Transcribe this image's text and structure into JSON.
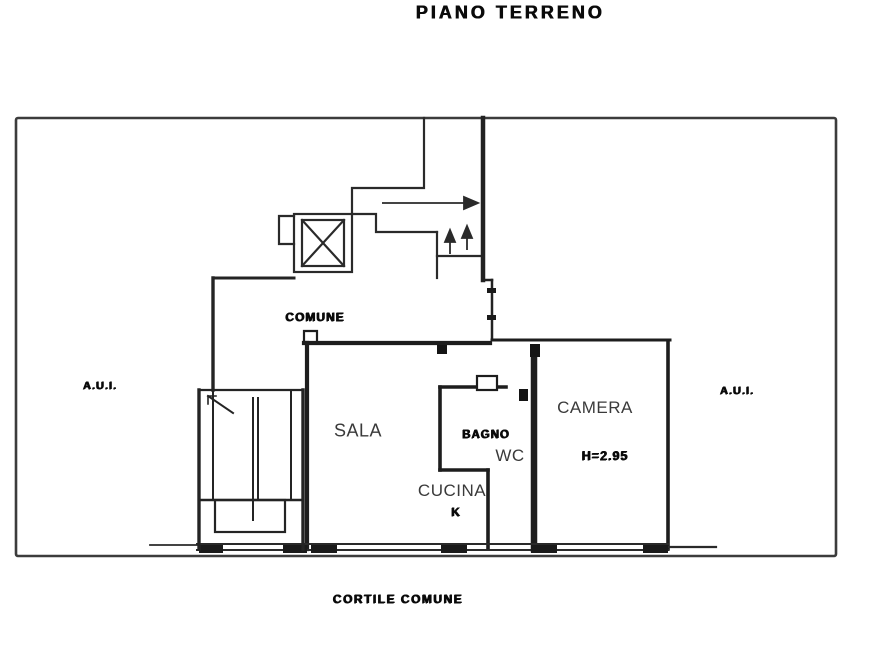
{
  "title": "PIANO TERRENO",
  "floor_plan": {
    "hall_label": "COMUNE",
    "left_area_label": "A.U.I.",
    "right_area_label": "A.U.I.",
    "courtyard_label": "CORTILE COMUNE",
    "rooms": {
      "sala": "SALA",
      "cucina": "CUCINA",
      "kitchen_mark": "K",
      "bagno": "BAGNO",
      "wc": "WC",
      "camera": "CAMERA",
      "height_note": "H=2.95"
    }
  }
}
